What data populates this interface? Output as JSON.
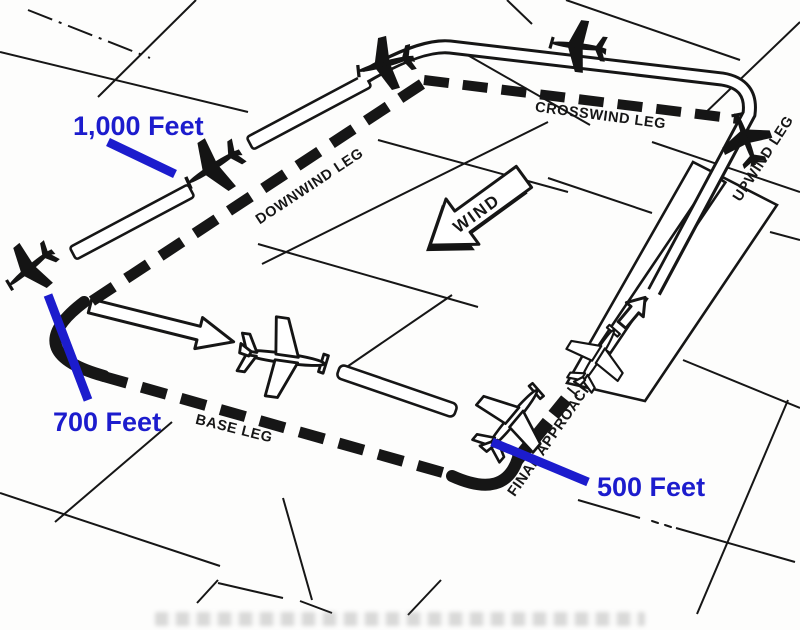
{
  "diagram": {
    "type": "airport-traffic-pattern",
    "legs": {
      "crosswind": "CROSSWIND LEG",
      "downwind": "DOWNWIND LEG",
      "upwind": "UPWIND LEG",
      "base": "BASE LEG",
      "final_approach": "FINAL APPROACH"
    },
    "wind_label": "WIND",
    "altitudes": {
      "downwind": "1,000 Feet",
      "base": "700 Feet",
      "final": "500 Feet"
    },
    "colors": {
      "altitude_blue": "#1c1ccd",
      "ink_black": "#161616",
      "paper": "#fdfdfc"
    }
  }
}
